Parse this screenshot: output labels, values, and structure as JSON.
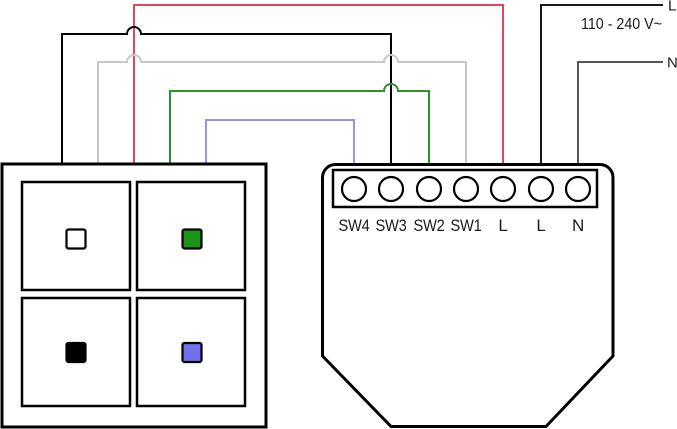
{
  "diagram": {
    "title": "relay-module-wiring-diagram",
    "power": {
      "line_label": "L",
      "neutral_label": "N",
      "voltage": "110 - 240 V~"
    },
    "module": {
      "terminals": [
        {
          "label": "SW4"
        },
        {
          "label": "SW3"
        },
        {
          "label": "SW2"
        },
        {
          "label": "SW1"
        },
        {
          "label": "L"
        },
        {
          "label": "L"
        },
        {
          "label": "N"
        }
      ]
    },
    "wires": [
      {
        "id": "red",
        "color": "red",
        "color_hex": "#e0475a",
        "to_terminal": "L"
      },
      {
        "id": "black",
        "color": "black",
        "color_hex": "#000000",
        "to_terminal": "SW3"
      },
      {
        "id": "gray",
        "color": "gray",
        "color_hex": "#c8c8c8",
        "to_terminal": "SW1"
      },
      {
        "id": "green",
        "color": "green",
        "color_hex": "#2f8f2f",
        "to_terminal": "SW2"
      },
      {
        "id": "blue",
        "color": "blue",
        "color_hex": "#9393ee",
        "to_terminal": "SW4"
      },
      {
        "id": "supply-l",
        "color": "black",
        "color_hex": "#1a1a1a",
        "to_terminal": "L"
      },
      {
        "id": "supply-n",
        "color": "gray",
        "color_hex": "#565656",
        "to_terminal": "N"
      }
    ],
    "switch_panel": {
      "buttons": [
        {
          "id": "top-left",
          "color": "white",
          "color_hex": "#ffffff"
        },
        {
          "id": "top-right",
          "color": "green",
          "color_hex": "#1b941b"
        },
        {
          "id": "bottom-left",
          "color": "black",
          "color_hex": "#000000"
        },
        {
          "id": "bottom-right",
          "color": "blue",
          "color_hex": "#7171ef"
        }
      ]
    }
  }
}
